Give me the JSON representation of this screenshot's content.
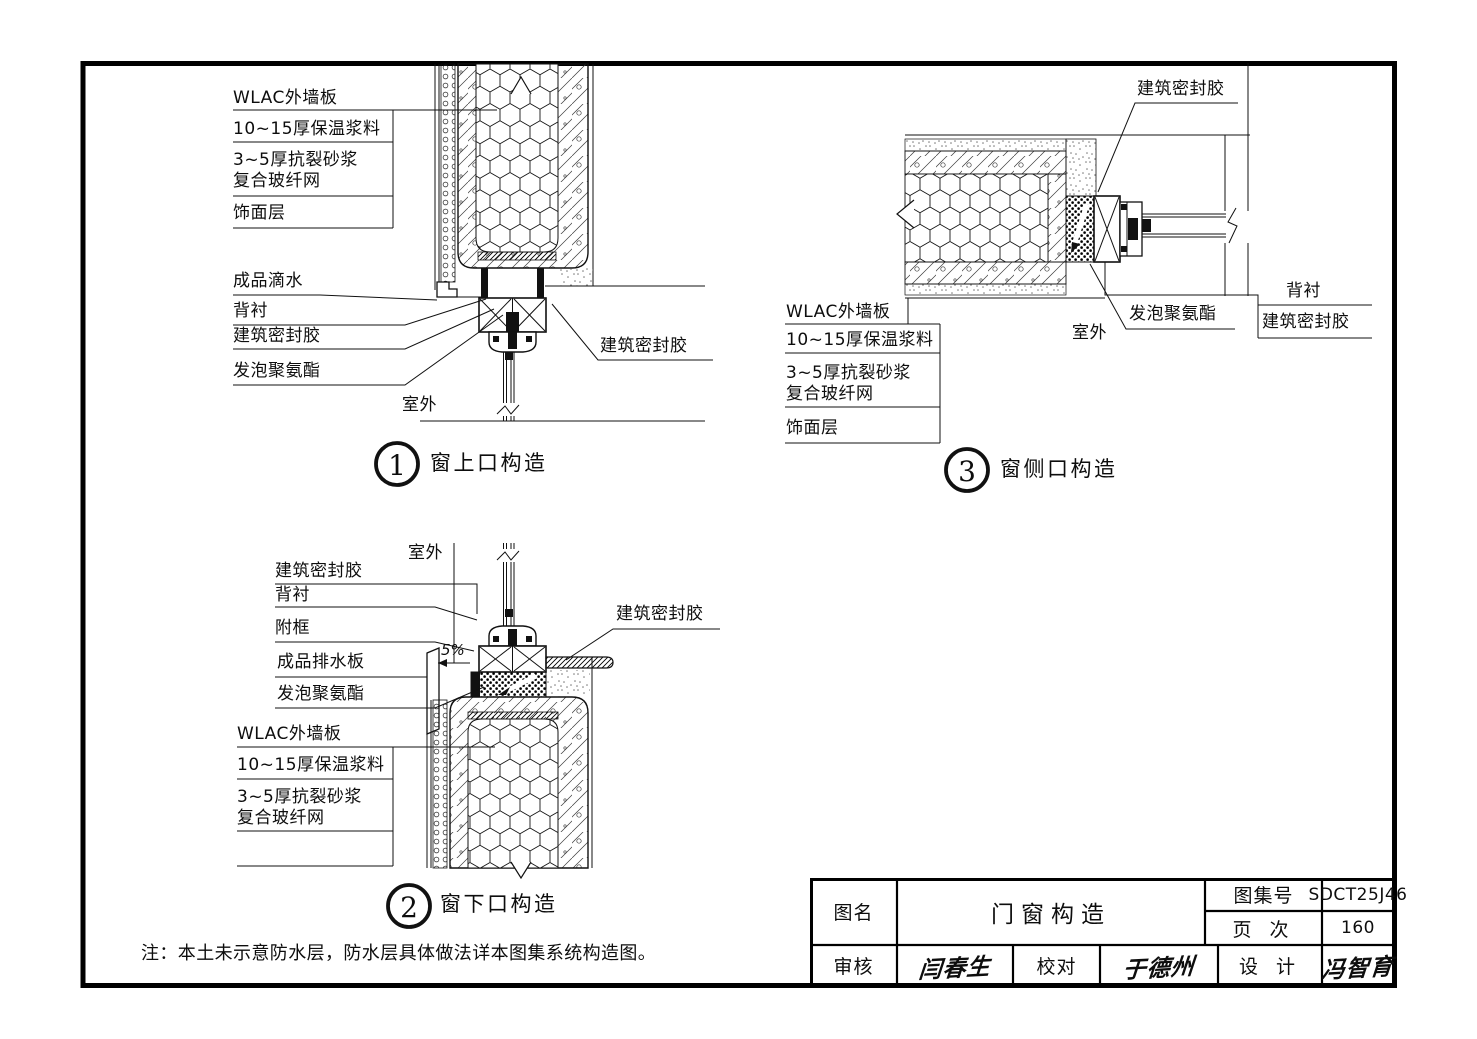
{
  "sheet": {
    "note": "注：本土未示意防水层，防水层具体做法详本图集系统构造图。"
  },
  "labels": {
    "wlac": "WLAC外墙板",
    "insulation": "10~15厚保温浆料",
    "mortar": "3~5厚抗裂砂浆\n复合玻纤网",
    "finish": "饰面层"
  },
  "leaders": {
    "drip": "成品滴水",
    "backing": "背衬",
    "sealant": "建筑密封胶",
    "foam": "发泡聚氨酯",
    "subframe": "附框",
    "drain_board": "成品排水板",
    "outdoor": "室外",
    "slope": "5%"
  },
  "callouts": {
    "d1": {
      "num": "1",
      "title": "窗上口构造"
    },
    "d2": {
      "num": "2",
      "title": "窗下口构造"
    },
    "d3": {
      "num": "3",
      "title": "窗侧口构造"
    }
  },
  "title_block": {
    "name_label": "图名",
    "name": "门窗构造",
    "atlas_label": "图集号",
    "atlas_no": "SDCT25J46",
    "page_label": "页 次",
    "page_no": "160",
    "audit_label": "审核",
    "audit_sig": "闫春生",
    "proof_label": "校对",
    "proof_sig": "于德州",
    "design_label": "设 计",
    "design_sig": "冯智育"
  }
}
